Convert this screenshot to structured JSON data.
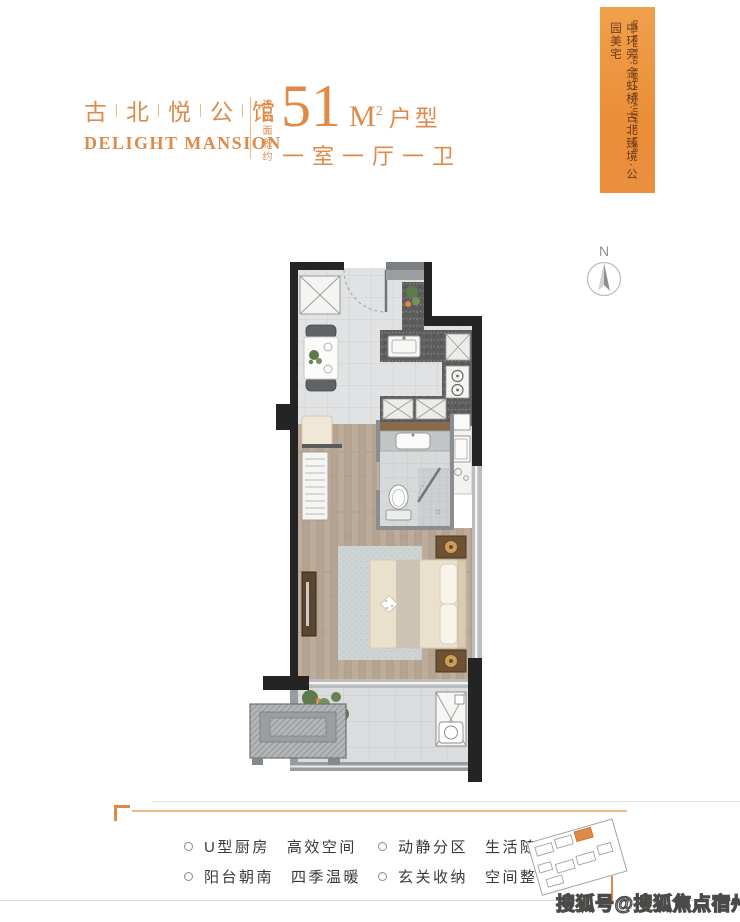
{
  "header": {
    "brand_cn": "古北悦公馆",
    "brand_en": "DELIGHT MANSION",
    "area_prefix": "建筑面积约",
    "area_number": "51",
    "area_unit": "M",
    "area_unit_sup": "2",
    "area_suffix": "户型",
    "layout_desc": "一室一厅一卫"
  },
  "banner": {
    "en": "DELIGHT TO SEE A BEAUTIFUL LIFE",
    "cn": "中环旁·金虹桥·古北臻境·公园美宅"
  },
  "compass": {
    "label": "N"
  },
  "features": [
    {
      "tag": "U型厨房",
      "desc": "高效空间"
    },
    {
      "tag": "阳台朝南",
      "desc": "四季温暖"
    },
    {
      "tag": "动静分区",
      "desc": "生活随心"
    },
    {
      "tag": "玄关收纳",
      "desc": "空间整洁"
    }
  ],
  "watermark": "搜狐号@搜狐焦点宿州站",
  "colors": {
    "accent": "#e08a48",
    "accent_light": "#f2b983",
    "banner": "#ec9440",
    "banner_text": "#6b3a1b",
    "wall": "#242424",
    "wall_gray": "#7c8082",
    "text_dark": "#3a3a3a"
  }
}
